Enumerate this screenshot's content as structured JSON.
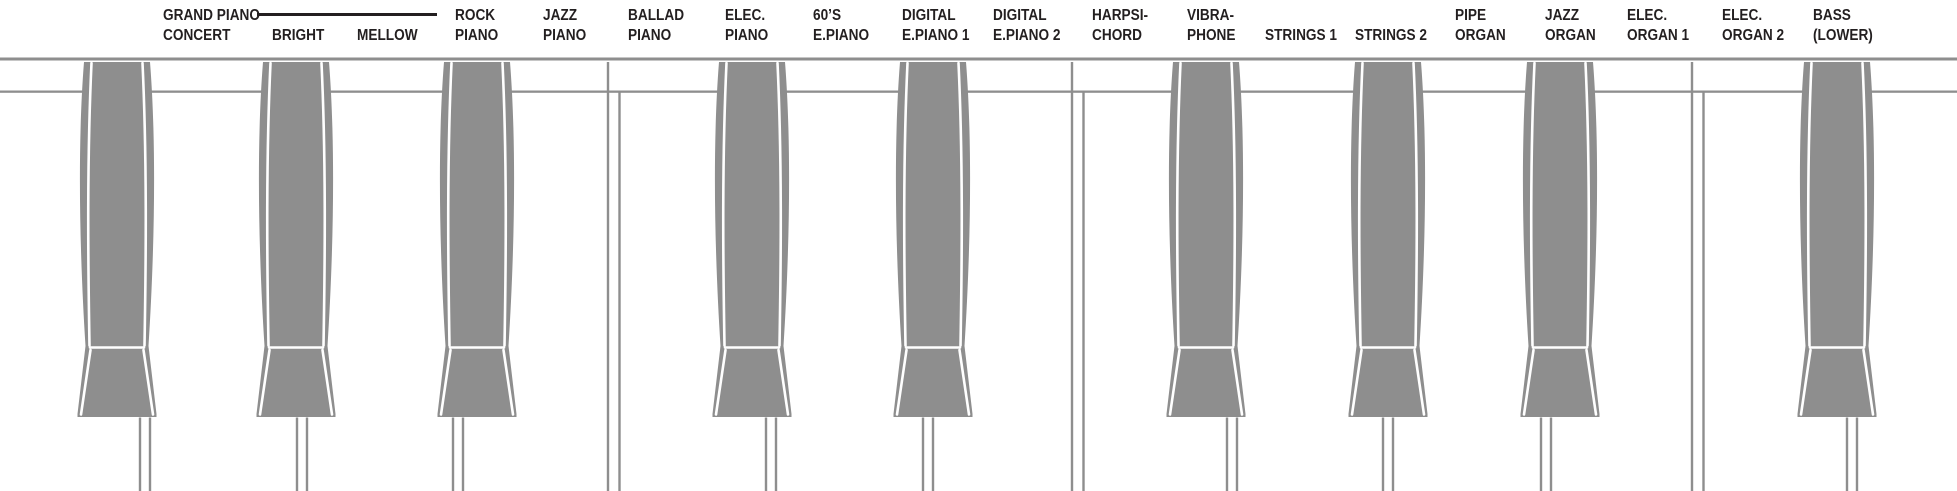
{
  "diagram": {
    "title": "voice-selection-key-diagram",
    "background": "#ffffff",
    "key_color": "#8e8e8e",
    "line_color": "#8e8e8e",
    "text_color": "#231f20"
  },
  "labels": [
    {
      "x": 163,
      "lines": [
        "GRAND PIANO",
        "CONCERT"
      ],
      "brace": {
        "x": 257,
        "y": 13,
        "width": 180
      }
    },
    {
      "x": 272,
      "lines": [
        "BRIGHT"
      ],
      "row": 2
    },
    {
      "x": 357,
      "lines": [
        "MELLOW"
      ],
      "row": 2
    },
    {
      "x": 455,
      "lines": [
        "ROCK",
        "PIANO"
      ]
    },
    {
      "x": 543,
      "lines": [
        "JAZZ",
        "PIANO"
      ]
    },
    {
      "x": 628,
      "lines": [
        "BALLAD",
        "PIANO"
      ]
    },
    {
      "x": 725,
      "lines": [
        "ELEC.",
        "PIANO"
      ]
    },
    {
      "x": 813,
      "lines": [
        "60’S",
        "E.PIANO"
      ]
    },
    {
      "x": 902,
      "lines": [
        "DIGITAL",
        "E.PIANO 1"
      ]
    },
    {
      "x": 993,
      "lines": [
        "DIGITAL",
        "E.PIANO 2"
      ]
    },
    {
      "x": 1092,
      "lines": [
        "HARPSI-",
        "CHORD"
      ]
    },
    {
      "x": 1187,
      "lines": [
        "VIBRA-",
        "PHONE"
      ]
    },
    {
      "x": 1265,
      "lines": [
        "STRINGS 1"
      ],
      "row": 2
    },
    {
      "x": 1355,
      "lines": [
        "STRINGS 2"
      ],
      "row": 2
    },
    {
      "x": 1455,
      "lines": [
        "PIPE",
        "ORGAN"
      ]
    },
    {
      "x": 1545,
      "lines": [
        "JAZZ",
        "ORGAN"
      ]
    },
    {
      "x": 1627,
      "lines": [
        "ELEC.",
        "ORGAN 1"
      ]
    },
    {
      "x": 1722,
      "lines": [
        "ELEC.",
        "ORGAN 2"
      ]
    },
    {
      "x": 1813,
      "lines": [
        "BASS",
        "(LOWER)"
      ]
    }
  ],
  "keyboard": {
    "width": 1957,
    "height": 491,
    "rails": [
      {
        "y": 57.5,
        "h": 3
      },
      {
        "y": 90.5,
        "h": 2.3
      }
    ],
    "key_top_y": 62,
    "key_junction_y": 346,
    "key_bottom_y": 417,
    "black_key_half_width": 39.5,
    "black_keys": [
      {
        "x": 117
      },
      {
        "x": 296
      },
      {
        "x": 477
      },
      {
        "x": 752
      },
      {
        "x": 933
      },
      {
        "x": 1206
      },
      {
        "x": 1388
      },
      {
        "x": 1560
      },
      {
        "x": 1837
      }
    ],
    "full_separators": [
      614,
      1078,
      1698
    ],
    "front_separators": [
      145,
      302,
      458,
      771,
      928,
      1232,
      1388,
      1546,
      1852
    ]
  }
}
